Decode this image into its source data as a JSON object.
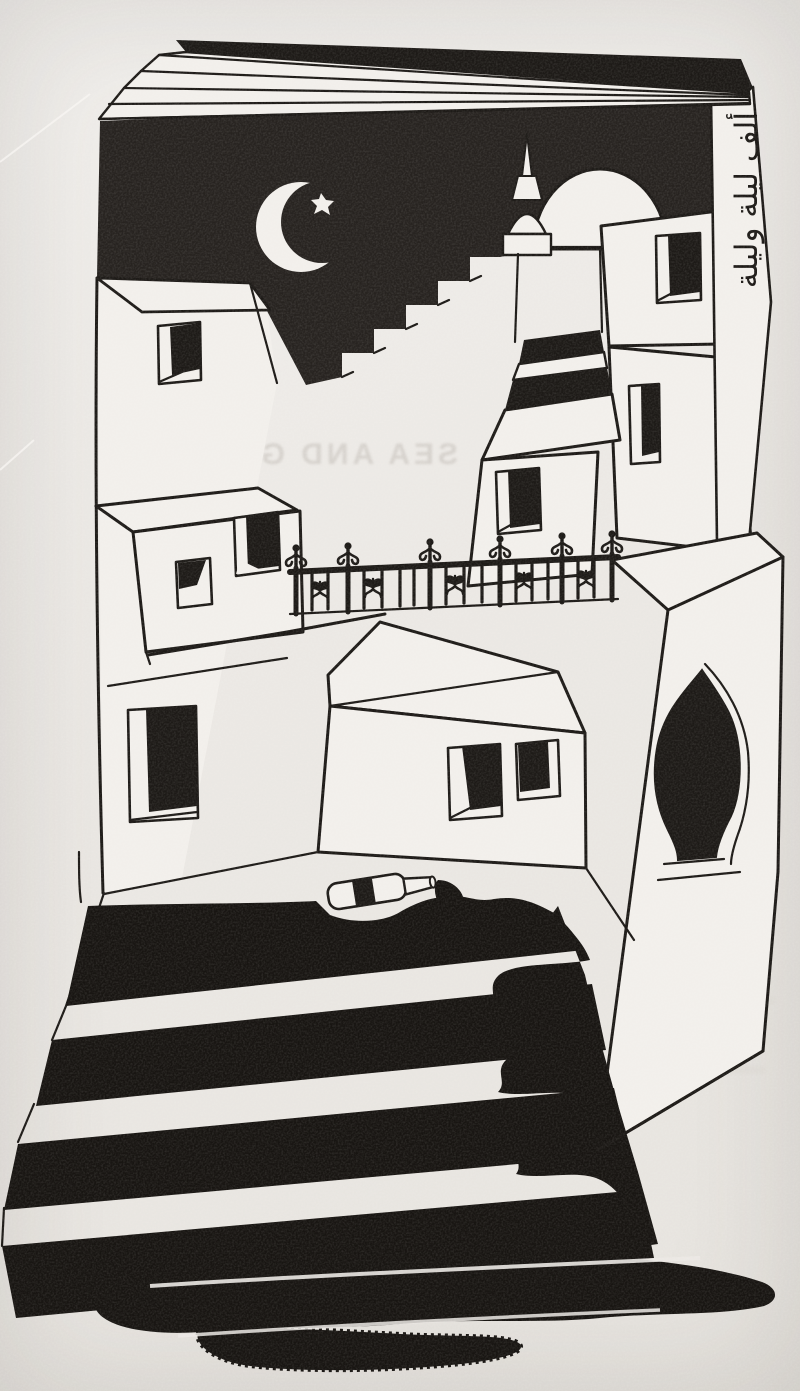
{
  "artwork": {
    "ghost_text": "SEA AND GRASS",
    "spine_calligraphy": "ألف ليلة وليلة",
    "colors": {
      "paper": "#ebe8e4",
      "building": "#f2efeb",
      "ink": "#1d1a17",
      "sky": "#272320",
      "liquid": "#181512"
    },
    "scene_elements": [
      "open-book-pages",
      "night-sky-cover",
      "crescent-moon",
      "star",
      "minaret",
      "mosque-dome",
      "skyline-steps",
      "village-buildings",
      "windows",
      "wrought-iron-fence",
      "ogee-arch-doorway",
      "fallen-bottle",
      "spilled-ink",
      "staircase",
      "ink-puddle",
      "arabic-spine-calligraphy"
    ]
  }
}
